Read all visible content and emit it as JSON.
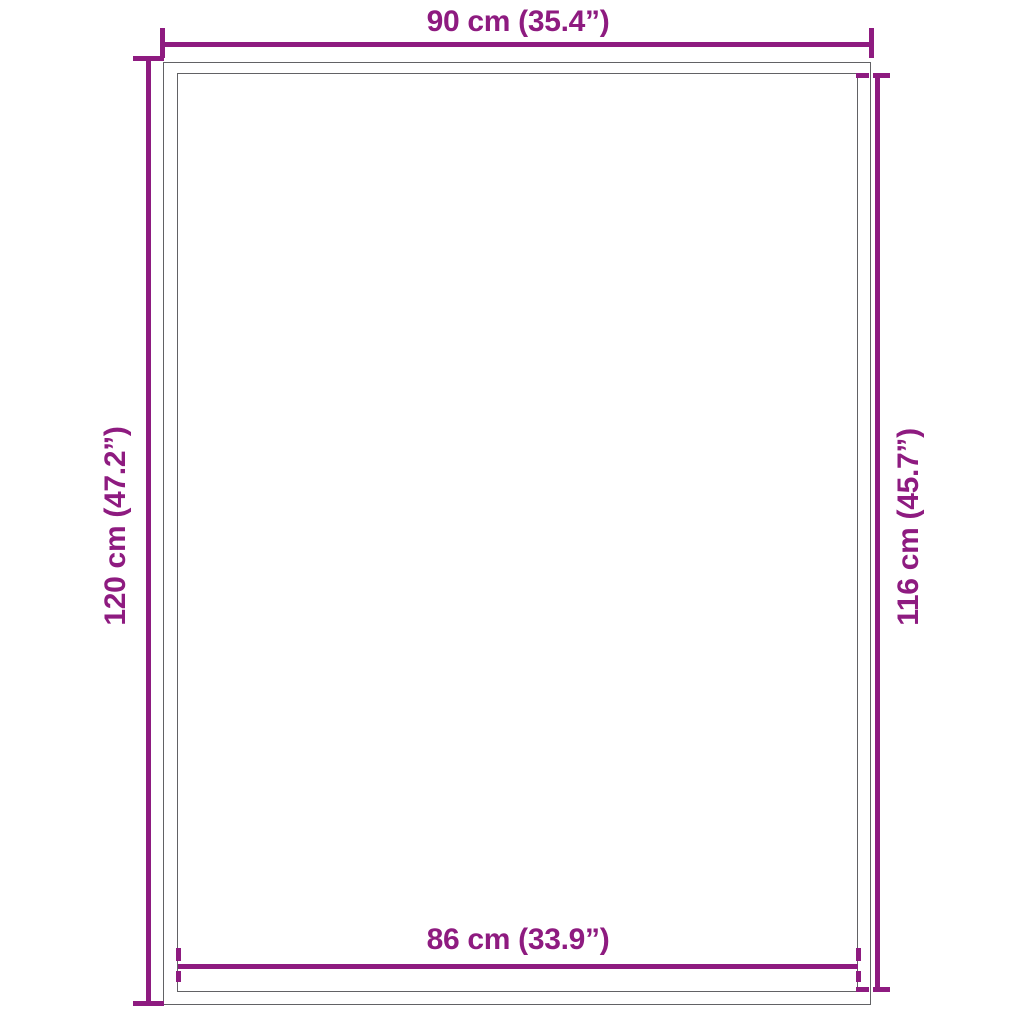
{
  "diagram": {
    "type": "product-dimension-diagram",
    "background_color": "#ffffff",
    "accent_color": "#8E1B80",
    "frame_color": "#626265",
    "object": {
      "shape": "rectangle-with-inner-border",
      "description": "rug/mat shown as outer frame with inner frame"
    },
    "dimensions": {
      "top": {
        "label": "90 cm (35.4”)",
        "measures": "outer-width",
        "value_cm": 90,
        "value_in": 35.4,
        "tick_style": "solid"
      },
      "left": {
        "label": "120 cm (47.2”)",
        "measures": "outer-height",
        "value_cm": 120,
        "value_in": 47.2,
        "tick_style": "solid"
      },
      "right": {
        "label": "116 cm (45.7”)",
        "measures": "inner-height",
        "value_cm": 116,
        "value_in": 45.7,
        "tick_style": "dashed"
      },
      "bottom": {
        "label": "86 cm (33.9”)",
        "measures": "inner-width",
        "value_cm": 86,
        "value_in": 33.9,
        "tick_style": "dashed"
      }
    }
  }
}
